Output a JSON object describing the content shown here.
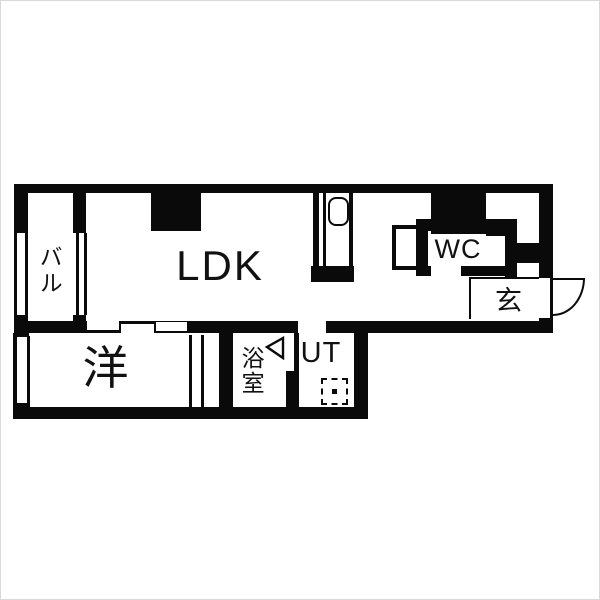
{
  "plan": {
    "type": "apartment-floor-plan",
    "rooms": {
      "balcony": {
        "label": "バル"
      },
      "ldk": {
        "label": "LDK"
      },
      "wc": {
        "label": "WC"
      },
      "entrance": {
        "label": "玄"
      },
      "western_room": {
        "label": "洋"
      },
      "bathroom": {
        "label": "浴室"
      },
      "utility": {
        "label": "UT"
      }
    },
    "fixtures": {
      "kitchen_sink": "sink",
      "washing_machine_pan": "dashed-square",
      "entrance_door_swing": "quarter-arc",
      "bathroom_door_swing": "left-arrow",
      "sliding_door_panels": 3
    },
    "colors": {
      "wall": "#0a0a0a",
      "floor": "#ffffff"
    }
  }
}
